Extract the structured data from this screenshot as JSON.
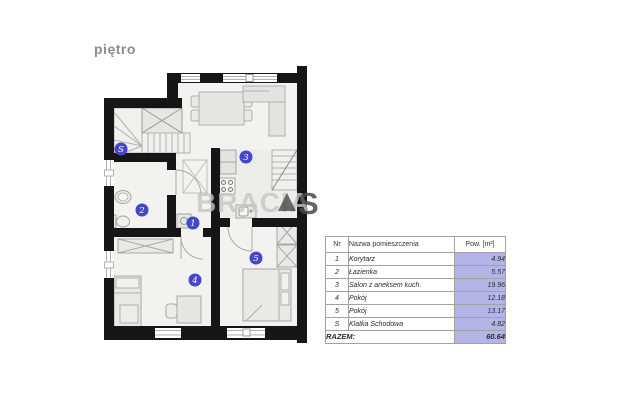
{
  "page": {
    "title": "piętro"
  },
  "watermark": {
    "text_primary": "BRACIA",
    "logo": "triangle-mark",
    "text_secondary": "S"
  },
  "colors": {
    "wall": "#161616",
    "plan_background": "#f2f2f1",
    "furniture_fill": "#e7e7e5",
    "room_label_blue": "#4646c9",
    "area_cell_lavender": "#b4b4e7",
    "title_gray": "#8c8c8c"
  },
  "plan": {
    "labels": {
      "corridor": "1",
      "bathroom": "2",
      "salon": "3",
      "room4": "4",
      "room5": "5",
      "stairs": "S"
    }
  },
  "table": {
    "headers": {
      "nr": "Nr",
      "name": "Nazwa pomieszczenia",
      "area": "Pow. [m²]"
    },
    "rows": [
      {
        "nr": "1",
        "name": "Korytarz",
        "area": "4.94"
      },
      {
        "nr": "2",
        "name": "Łazienka",
        "area": "5.57"
      },
      {
        "nr": "3",
        "name": "Salon z aneksem kuch.",
        "area": "19.96"
      },
      {
        "nr": "4",
        "name": "Pokój",
        "area": "12.18"
      },
      {
        "nr": "5",
        "name": "Pokój",
        "area": "13.17"
      },
      {
        "nr": "S",
        "name": "Klatka Schodowa",
        "area": "4.82"
      }
    ],
    "footer": {
      "label": "RAZEM:",
      "total": "60.64"
    }
  }
}
